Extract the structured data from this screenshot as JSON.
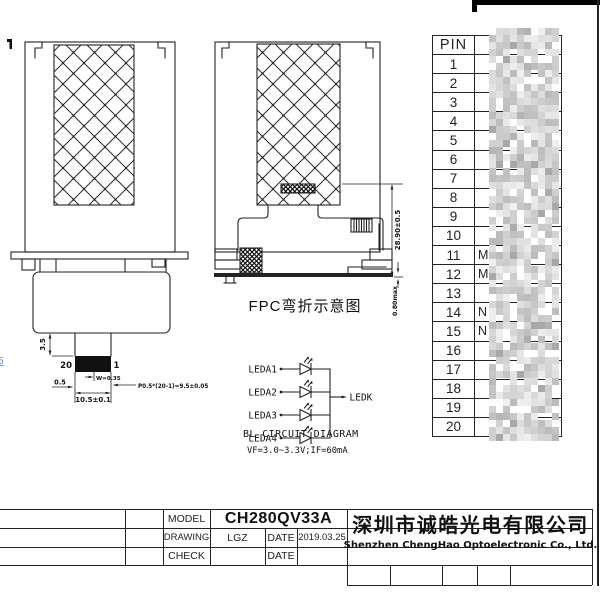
{
  "colors": {
    "ink": "#222222",
    "paper": "#ffffff",
    "connector": "#111111",
    "artifact_blue": "#5c8fc7"
  },
  "front_view": {
    "dim_tail_length": "3.5",
    "pin_label_left": "20",
    "pin_label_right": "1",
    "dim_pin_width": "W=0.35",
    "dim_edge_margin": "0.5",
    "dim_pitch": "P0.5*(20-1)=9.5±0.05",
    "dim_connector_width": "10.5±0.1",
    "edge_artifact": "5"
  },
  "side_view": {
    "caption": "FPC弯折示意图",
    "dim_fpc_height": "28.90±0.5",
    "dim_thickness": "0.80max"
  },
  "bl_circuit": {
    "title": "BL CIRCUIT DIAGRAM",
    "spec": "VF=3.0~3.3V;IF=60mA",
    "anodes": [
      "LEDA1",
      "LEDA2",
      "LEDA3",
      "LEDA4"
    ],
    "cathode": "LEDK"
  },
  "pin_table": {
    "header": "PIN",
    "rows": [
      {
        "pin": "1",
        "signal": ""
      },
      {
        "pin": "2",
        "signal": ""
      },
      {
        "pin": "3",
        "signal": ""
      },
      {
        "pin": "4",
        "signal": ""
      },
      {
        "pin": "5",
        "signal": ""
      },
      {
        "pin": "6",
        "signal": ""
      },
      {
        "pin": "7",
        "signal": ""
      },
      {
        "pin": "8",
        "signal": ""
      },
      {
        "pin": "9",
        "signal": ""
      },
      {
        "pin": "10",
        "signal": ""
      },
      {
        "pin": "11",
        "signal": "M"
      },
      {
        "pin": "12",
        "signal": "M"
      },
      {
        "pin": "13",
        "signal": ""
      },
      {
        "pin": "14",
        "signal": "N"
      },
      {
        "pin": "15",
        "signal": "N"
      },
      {
        "pin": "16",
        "signal": ""
      },
      {
        "pin": "17",
        "signal": ""
      },
      {
        "pin": "18",
        "signal": ""
      },
      {
        "pin": "19",
        "signal": ""
      },
      {
        "pin": "20",
        "signal": ""
      }
    ]
  },
  "title_block": {
    "model_label": "MODEL",
    "model_value": "CH280QV33A",
    "drawing_label": "DRAWING",
    "drawing_value": "LGZ",
    "date_label_1": "DATE",
    "date_value_1": "2019.03.25",
    "check_label": "CHECK",
    "date_label_2": "DATE",
    "company_cn": "深圳市诚皓光电有限公司",
    "company_en": "Shenzhen ChengHao Optoelectronic Co., Ltd."
  }
}
